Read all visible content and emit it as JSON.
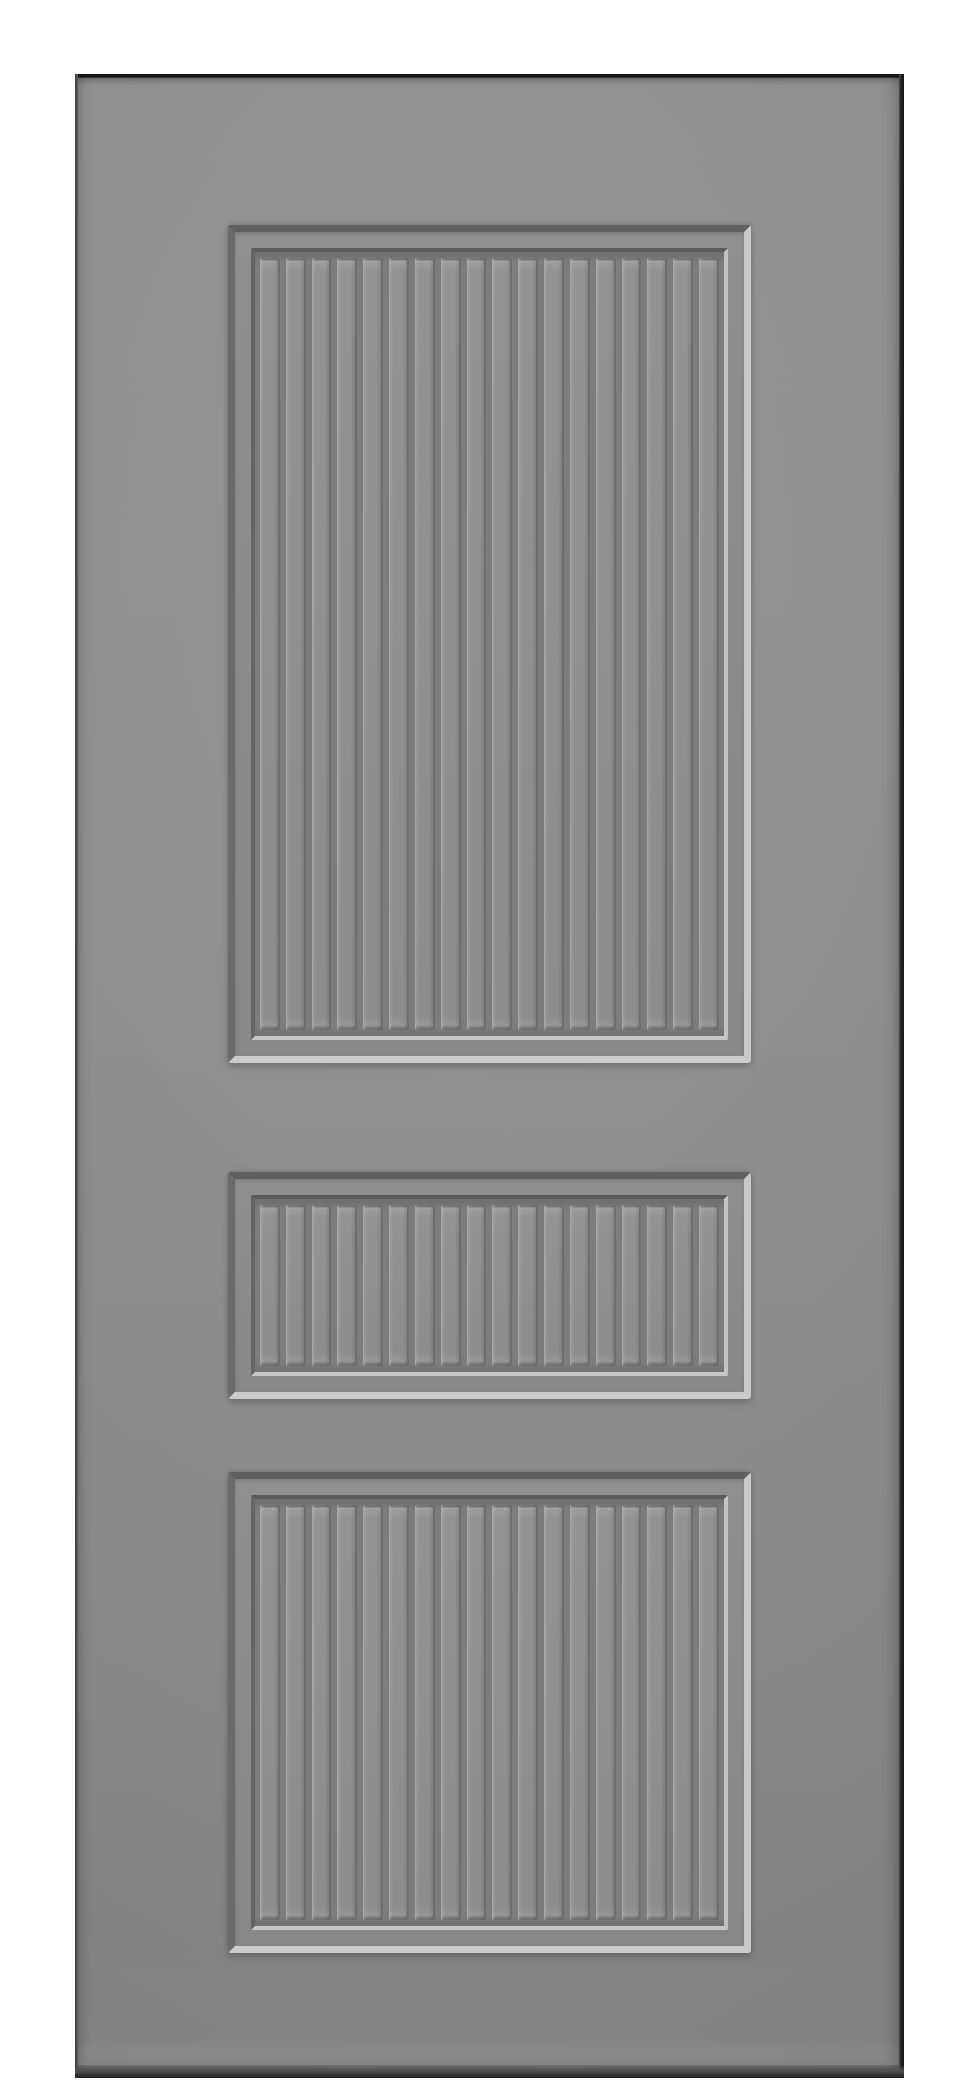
{
  "scene": {
    "description": "Product photograph of a gray three-panel door leaf with vertical beadboard-grooved recessed panels, centered on a plain white background",
    "background_color": "#ffffff"
  },
  "door": {
    "label": "gray door leaf",
    "face_color": "#8c8c8c",
    "edge_colors": {
      "top": "#141414",
      "right": "#1a1a1a",
      "left": "#3c3c3c",
      "bottom": "#1f1f1f"
    }
  },
  "panels": [
    {
      "id": "top",
      "label": "top recessed beadboard panel (tall)",
      "plank_count": 18
    },
    {
      "id": "middle",
      "label": "middle recessed beadboard panel (short)",
      "plank_count": 18
    },
    {
      "id": "bottom",
      "label": "bottom recessed beadboard panel (medium)",
      "plank_count": 18
    }
  ],
  "finish": {
    "recess_bevel": {
      "top": "#5f5f5f",
      "left": "#6a6a6a",
      "right": "#c9c9c9",
      "bottom": "#cccccc"
    },
    "inner_lip": {
      "top": "#5a5a5a",
      "left": "#646464",
      "right": "#c3c3c3",
      "bottom": "#c7c7c7"
    },
    "field_channel": "#7d7d7d",
    "plank_face": "#8f8f8f",
    "plank_highlight": "#a8a8a8",
    "plank_shadow": "#6e6e6e"
  }
}
